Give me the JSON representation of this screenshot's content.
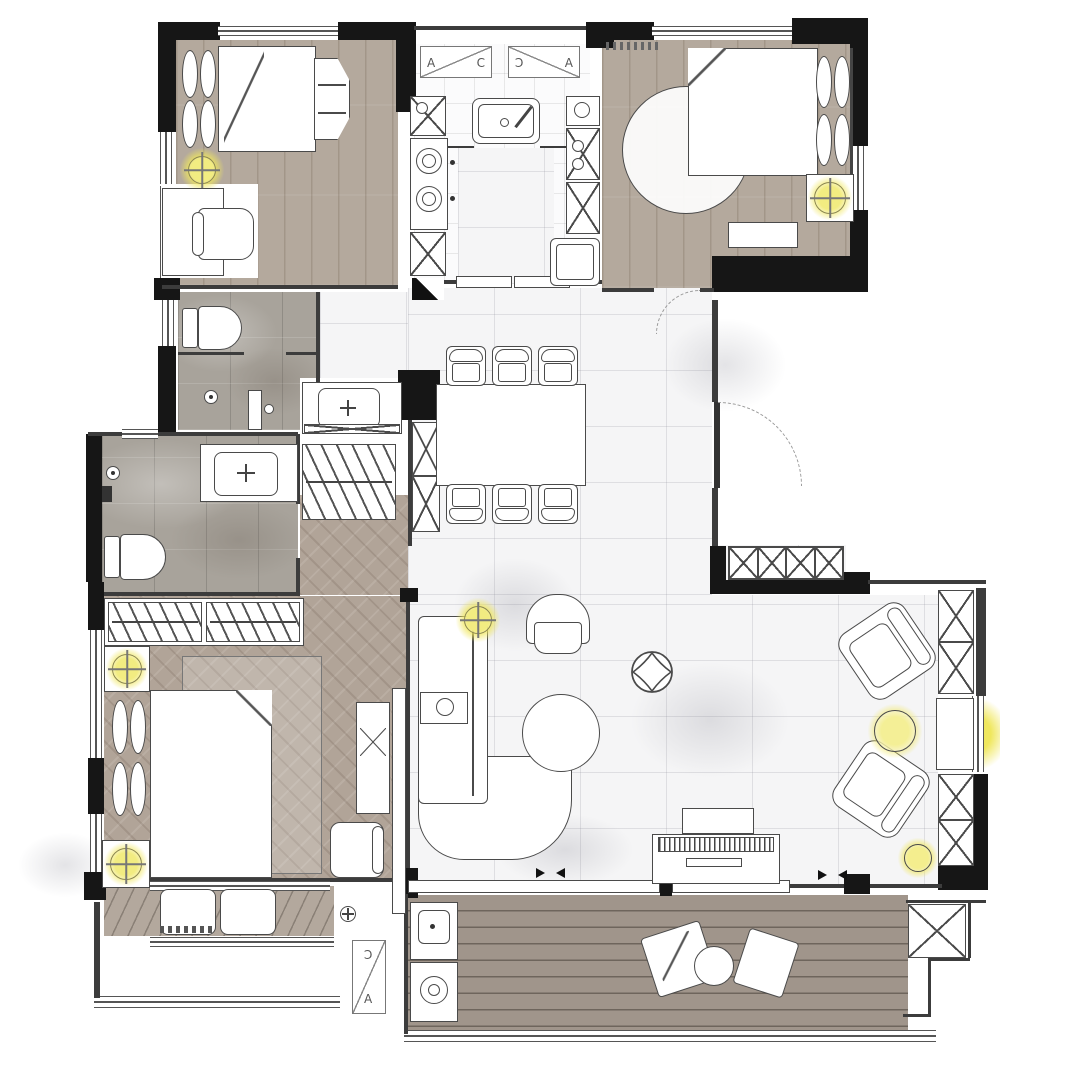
{
  "window_tags": {
    "kitchen_left": {
      "left": "A",
      "right": "C"
    },
    "kitchen_right": {
      "left": "C",
      "right": "A"
    },
    "balcony_small": {
      "top": "C",
      "bottom": "A"
    }
  },
  "colors": {
    "wall": "#161616",
    "thin": "#3c3c3c",
    "line": "#4a4a4a",
    "wood": "#b4a99d",
    "herr": "#b1a498",
    "stone": "#a8a39b",
    "marble": "#f5f5f6",
    "deck": "#9e938a",
    "glow": "#efe75e"
  }
}
